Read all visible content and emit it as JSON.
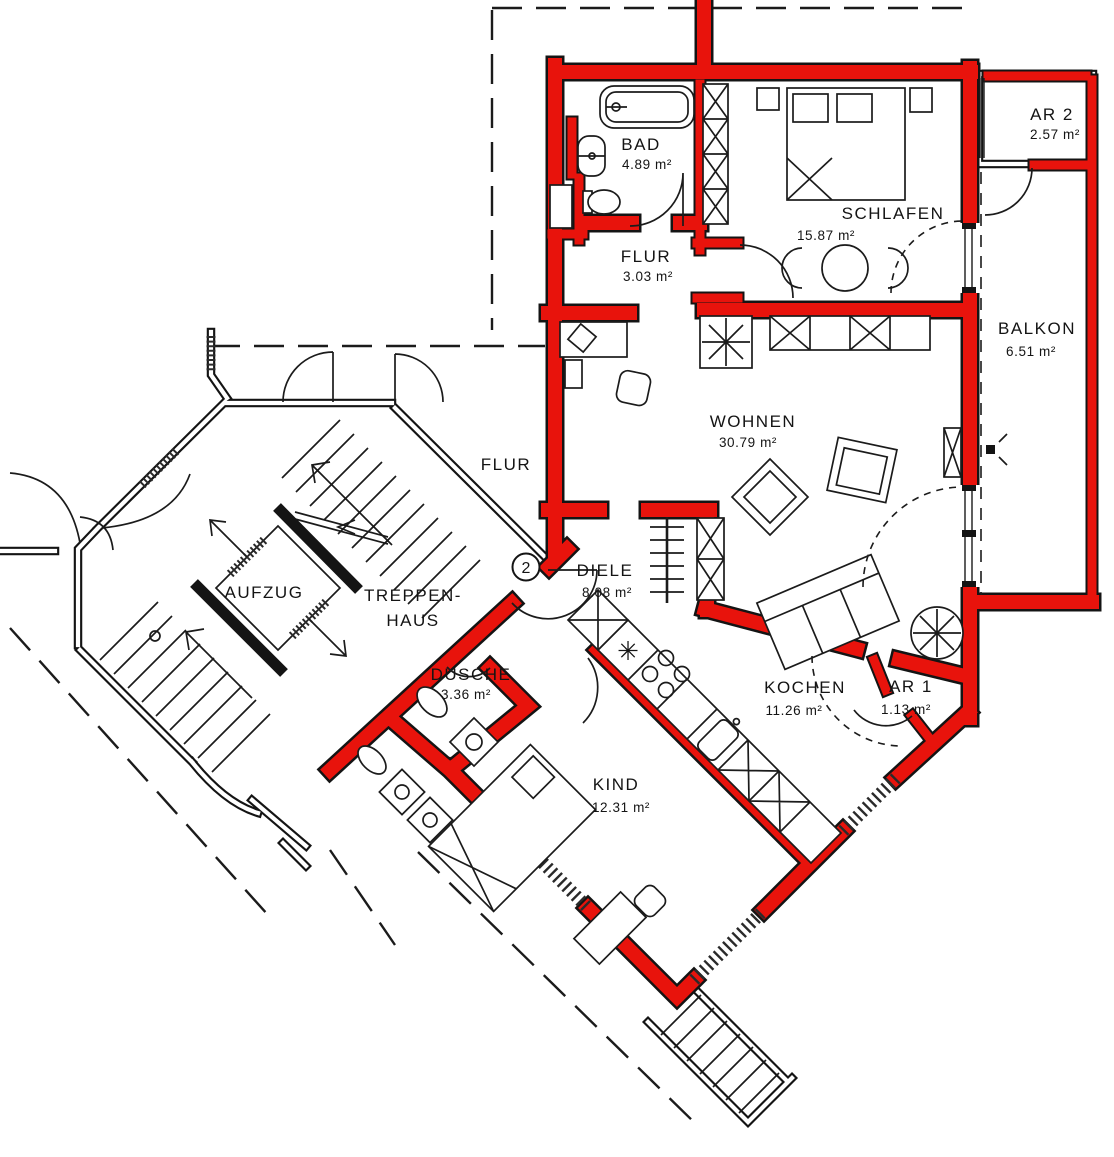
{
  "plan": {
    "unit_number": "2",
    "colors": {
      "wall_red": "#e8130c",
      "line_black": "#141414",
      "background": "#ffffff"
    }
  },
  "rooms": {
    "bad": {
      "name": "BAD",
      "area": "4.89 m²"
    },
    "flur_apt": {
      "name": "FLUR",
      "area": "3.03 m²"
    },
    "schlafen": {
      "name": "SCHLAFEN",
      "area": "15.87 m²"
    },
    "ar2": {
      "name": "AR 2",
      "area": "2.57 m²"
    },
    "balkon": {
      "name": "BALKON",
      "area": "6.51 m²"
    },
    "wohnen": {
      "name": "WOHNEN",
      "area": "30.79 m²"
    },
    "diele": {
      "name": "DIELE",
      "area": "8.08 m²"
    },
    "dusche": {
      "name": "DUSCHE",
      "area": "3.36 m²"
    },
    "kochen": {
      "name": "KOCHEN",
      "area": "11.26 m²"
    },
    "ar1": {
      "name": "AR 1",
      "area": "1.13 m²"
    },
    "kind": {
      "name": "KIND",
      "area": "12.31 m²"
    }
  },
  "common": {
    "aufzug": {
      "name": "AUFZUG"
    },
    "treppenhaus": {
      "line1": "TREPPEN-",
      "line2": "HAUS"
    },
    "flur": {
      "name": "FLUR"
    }
  }
}
